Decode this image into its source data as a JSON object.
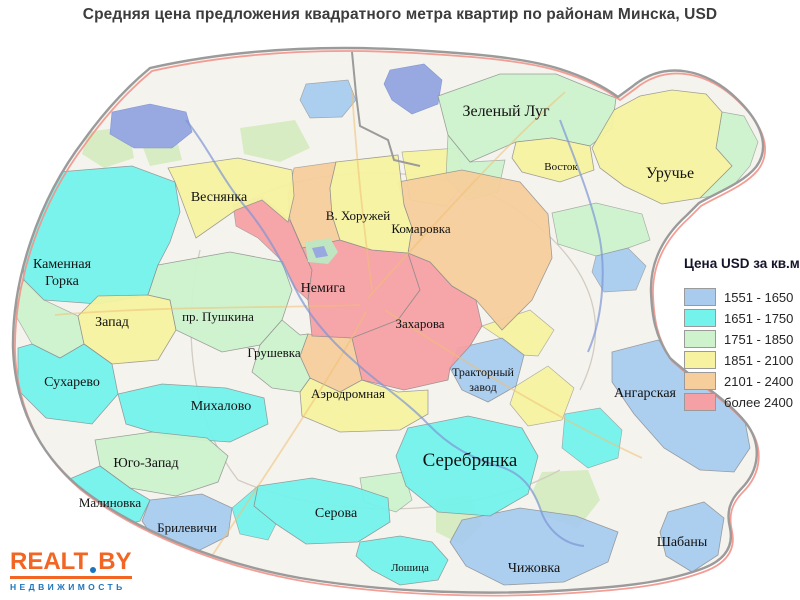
{
  "title": "Средняя цена предложения квадратного метра квартир по районам Минска, USD",
  "legend": {
    "title": "Цена USD за кв.м.",
    "items": [
      {
        "label": "1551 - 1650",
        "color": "#A8CBEE"
      },
      {
        "label": "1651 - 1750",
        "color": "#74F2EC"
      },
      {
        "label": "1751 - 1850",
        "color": "#CDF2CC"
      },
      {
        "label": "1851 - 2100",
        "color": "#F6F2A0"
      },
      {
        "label": "2101 - 2400",
        "color": "#F6CE9C"
      },
      {
        "label": "более 2400",
        "color": "#F5A0A4"
      }
    ]
  },
  "logo": {
    "brand_left": "REALT",
    "brand_right": "BY",
    "tagline": "НЕДВИЖИМОСТЬ",
    "accent_color": "#F26522",
    "blue_color": "#1C75BC"
  },
  "map": {
    "base_color": "#f5f3ee",
    "boundary_color": "#9b9b9b",
    "ring_road_color": "#f2948a",
    "park_color": "#d7ecc3",
    "water_color": "#98a8e0",
    "label_color": "#121212",
    "districts": [
      {
        "name": "Каменная Горка",
        "category": 1,
        "label": {
          "lines": [
            "Каменная",
            "Горка"
          ],
          "x": 62,
          "y": 268,
          "size": 14
        },
        "points": "58,172 132,166 175,182 180,212 170,242 158,265 148,295 98,304 44,300 24,280 22,242 36,206"
      },
      {
        "name": "Запад",
        "category": 3,
        "label": {
          "lines": [
            "Запад"
          ],
          "x": 112,
          "y": 326,
          "size": 14
        },
        "points": "98,296 148,295 170,300 176,330 158,360 112,364 84,344 78,316"
      },
      {
        "name": "пр. Пушкина",
        "category": 2,
        "label": {
          "lines": [
            "пр. Пушкина"
          ],
          "x": 218,
          "y": 321,
          "size": 13
        },
        "points": "158,265 230,252 282,262 292,290 282,320 260,345 222,352 176,330 170,300 148,295"
      },
      {
        "name": "Сухарево",
        "category": 1,
        "label": {
          "lines": [
            "Сухарево"
          ],
          "x": 72,
          "y": 386,
          "size": 14
        },
        "points": "18,348 32,344 60,358 84,344 112,364 118,394 92,424 46,418 18,390"
      },
      {
        "name": "Михалово",
        "category": 1,
        "label": {
          "lines": [
            "Михалово"
          ],
          "x": 221,
          "y": 410,
          "size": 14
        },
        "points": "118,394 162,384 226,388 264,398 268,424 230,442 172,438 126,424"
      },
      {
        "name": "Юго-Запад",
        "category": 2,
        "label": {
          "lines": [
            "Юго-Запад"
          ],
          "x": 146,
          "y": 467,
          "size": 14
        },
        "points": "95,440 152,432 207,438 228,456 218,482 176,496 130,488 100,466"
      },
      {
        "name": "Малиновка",
        "category": 1,
        "label": {
          "lines": [
            "Малиновка"
          ],
          "x": 110,
          "y": 507,
          "size": 13
        },
        "points": "44,490 100,466 130,488 150,500 140,521 100,531 60,512"
      },
      {
        "name": "Брилевичи",
        "category": 0,
        "label": {
          "lines": [
            "Брилевичи"
          ],
          "x": 187,
          "y": 532,
          "size": 13
        },
        "points": "150,500 202,494 232,508 228,536 194,553 157,543 142,521"
      },
      {
        "name": "Серова",
        "category": 1,
        "label": {
          "lines": [
            "Серова"
          ],
          "x": 336,
          "y": 517,
          "size": 14
        },
        "points": "258,486 312,478 352,486 388,498 390,522 358,542 306,544 276,524 254,506"
      },
      {
        "name": "Лошица",
        "category": 1,
        "label": {
          "lines": [
            "Лошица"
          ],
          "x": 410,
          "y": 571,
          "size": 11
        },
        "points": "360,542 400,536 432,542 448,560 438,580 400,585 372,570 356,556"
      },
      {
        "name": "Чижовка",
        "category": 0,
        "label": {
          "lines": [
            "Чижовка"
          ],
          "x": 534,
          "y": 572,
          "size": 14
        },
        "points": "462,520 520,508 576,516 618,532 608,562 564,582 504,585 466,566 450,542"
      },
      {
        "name": "Шабаны",
        "category": 0,
        "label": {
          "lines": [
            "Шабаны"
          ],
          "x": 682,
          "y": 546,
          "size": 14
        },
        "points": "668,512 704,502 724,518 718,555 692,572 666,556 660,532"
      },
      {
        "name": "Серебрянка",
        "category": 1,
        "label": {
          "lines": [
            "Серебрянка"
          ],
          "x": 470,
          "y": 466,
          "size": 19
        },
        "points": "408,428 468,416 522,428 538,456 528,494 490,516 438,512 406,486 396,456"
      },
      {
        "name": "Ангарская",
        "category": 0,
        "label": {
          "lines": [
            "Ангарская"
          ],
          "x": 645,
          "y": 397,
          "size": 14
        },
        "points": "612,352 658,340 688,362 716,388 744,416 750,448 734,472 700,470 664,448 634,414 612,382"
      },
      {
        "name": "Тракторный завод",
        "category": 0,
        "label": {
          "lines": [
            "Тракторный",
            "завод"
          ],
          "x": 483,
          "y": 376,
          "size": 12
        },
        "points": "458,348 502,338 524,355 516,386 488,402 462,390 450,368"
      },
      {
        "name": "Аэродромная",
        "category": 3,
        "label": {
          "lines": [
            "Аэродромная"
          ],
          "x": 348,
          "y": 398,
          "size": 13
        },
        "points": "300,392 310,378 340,392 362,380 398,392 428,390 428,414 400,430 340,432 302,416"
      },
      {
        "name": "Грушевка",
        "category": 2,
        "label": {
          "lines": [
            "Грушевка"
          ],
          "x": 274,
          "y": 357,
          "size": 13
        },
        "points": "260,345 282,320 300,335 308,334 300,356 310,378 300,392 272,388 252,372"
      },
      {
        "name": "Немига",
        "category": 5,
        "label": {
          "lines": [
            "Немига"
          ],
          "x": 323,
          "y": 292,
          "size": 14
        },
        "points": "290,220 302,248 340,240 372,250 408,253 420,290 398,320 352,338 312,336 308,300 312,270"
      },
      {
        "name": "Захарова",
        "category": 5,
        "label": {
          "lines": [
            "Захарова"
          ],
          "x": 420,
          "y": 328,
          "size": 13
        },
        "points": "408,253 430,262 452,286 476,300 482,326 470,346 450,368 448,380 404,390 362,380 352,338 398,320 420,290"
      },
      {
        "name": "Комаровка",
        "category": 4,
        "label": {
          "lines": [
            "Комаровка"
          ],
          "x": 421,
          "y": 233,
          "size": 13
        },
        "points": "398,182 462,170 520,182 548,214 552,258 532,300 502,330 476,300 452,286 430,262 408,253 412,228 404,205"
      },
      {
        "name": "В. Хоружей",
        "category": 3,
        "label": {
          "lines": [
            "В. Хоружей"
          ],
          "x": 358,
          "y": 220,
          "size": 13
        },
        "points": "336,162 398,155 404,205 412,228 408,253 372,250 340,240 332,215 330,188"
      },
      {
        "name": "Веснянка",
        "category": 3,
        "label": {
          "lines": [
            "Веснянка"
          ],
          "x": 219,
          "y": 201,
          "size": 14
        },
        "points": "168,168 238,158 292,170 294,196 288,222 262,200 236,210 196,238 175,182"
      },
      {
        "name": "Зеленый Луг",
        "category": 2,
        "label": {
          "lines": [
            "Зеленый Луг"
          ],
          "x": 506,
          "y": 116,
          "size": 16
        },
        "points": "438,96 500,74 556,74 600,92 616,98 612,128 590,146 552,138 516,142 470,162 448,135"
      },
      {
        "name": "Восток",
        "category": 3,
        "label": {
          "lines": [
            "Восток"
          ],
          "x": 561,
          "y": 170,
          "size": 11
        },
        "points": "516,142 552,138 590,146 594,170 560,182 522,172 512,158"
      },
      {
        "name": "Уручье",
        "category": 3,
        "label": {
          "lines": [
            "Уручье"
          ],
          "x": 670,
          "y": 178,
          "size": 16
        },
        "points": "592,148 614,110 640,96 672,90 706,94 722,112 716,148 732,166 700,198 662,204 624,186 600,168"
      }
    ],
    "patches": [
      {
        "category": 4,
        "points": "294,168 336,162 330,188 332,215 340,240 302,248 290,220 288,195"
      },
      {
        "category": 5,
        "points": "233,205 262,197 290,220 302,248 312,270 308,300 295,288 283,262 258,238 236,226"
      },
      {
        "category": 4,
        "points": "308,334 352,338 362,380 340,392 310,378 300,356"
      },
      {
        "category": 3,
        "points": "402,152 458,148 464,184 446,206 410,200"
      },
      {
        "category": 0,
        "points": "306,84 348,80 356,100 342,117 310,118 300,100"
      },
      {
        "category": 2,
        "points": "448,135 470,162 505,160 498,192 468,200 446,178"
      },
      {
        "category": 2,
        "points": "722,112 744,116 758,142 750,166 726,194 700,198 732,166 716,148"
      },
      {
        "category": 2,
        "points": "552,213 596,203 642,214 650,240 628,248 596,256 558,244"
      },
      {
        "category": 0,
        "points": "596,256 628,248 646,266 636,290 604,292 592,272"
      },
      {
        "category": 3,
        "points": "476,328 530,310 554,330 538,356 522,355 500,338 482,326"
      },
      {
        "category": 3,
        "points": "516,386 548,366 574,388 562,420 528,426 510,404"
      },
      {
        "category": 1,
        "points": "565,414 600,408 622,430 618,458 588,468 562,448"
      },
      {
        "category": 2,
        "points": "24,280 44,300 78,316 84,344 60,358 32,344 16,316 18,292"
      },
      {
        "category": 2,
        "points": "360,478 404,472 412,500 396,512 364,502"
      },
      {
        "category": 1,
        "points": "232,508 258,486 254,506 276,524 268,540 240,534"
      }
    ]
  }
}
